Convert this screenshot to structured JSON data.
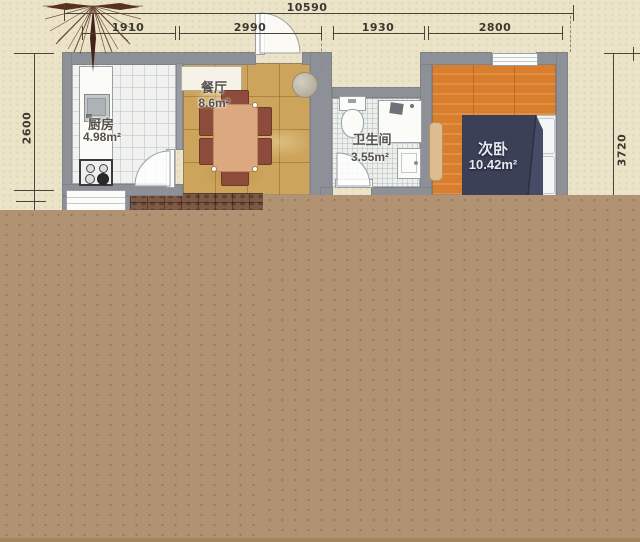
{
  "plan_title": "一居户型图",
  "dims": {
    "total": "10590",
    "segments": [
      {
        "label": "1910"
      },
      {
        "label": "2990"
      },
      {
        "label": "1930"
      },
      {
        "label": "2800"
      }
    ],
    "left": "2600",
    "right": "3720"
  },
  "rooms": {
    "kitchen": {
      "name": "厨房",
      "area": "4.98m²"
    },
    "dining": {
      "name": "餐厅",
      "area": "8.6m²"
    },
    "bathroom": {
      "name": "卫生间",
      "area": "3.55m²"
    },
    "bedroom": {
      "name": "次卧",
      "area": "10.42m²"
    }
  },
  "colors": {
    "background_cream": "#ece4c9",
    "wall_gray": "#8d9096",
    "dining_gold": "#cda45c",
    "bedroom_wood": "#d87e2d",
    "bed_navy": "#3c4056",
    "chair_maroon": "#8d4c3b",
    "table_salmon": "#dca87f",
    "cutoff_brown": "#b19373",
    "dimension_text": "#3c382f"
  }
}
